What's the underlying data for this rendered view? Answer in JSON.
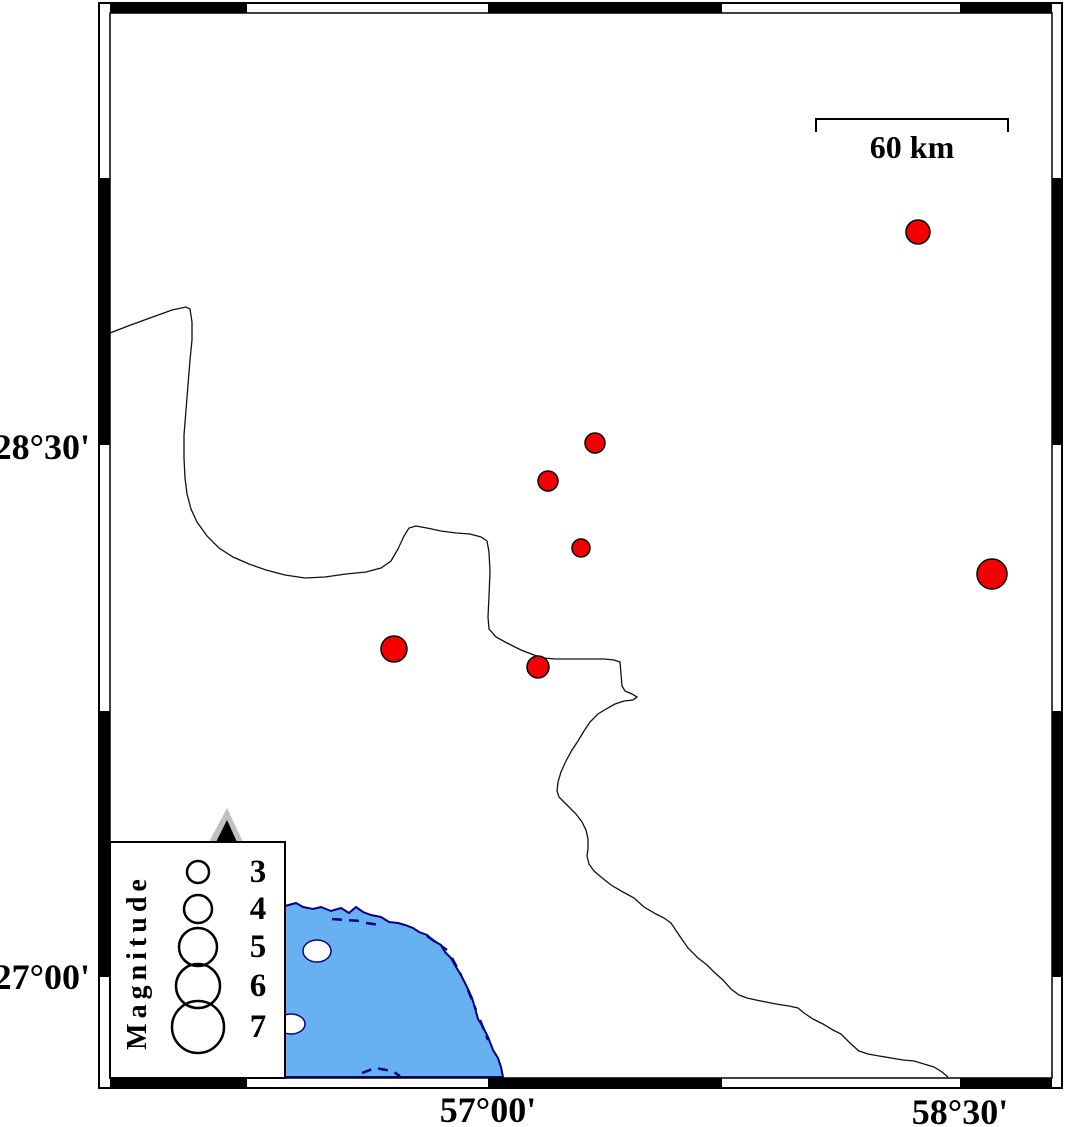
{
  "map": {
    "colors": {
      "sea_fill": "#67B1F0",
      "coast_stroke": "#00008B",
      "quake_fill": "#F50000",
      "land_fill": "#FFFFFF",
      "frame_black": "#000000",
      "volcano_gray": "#C0C0C0",
      "volcano_black": "#000000"
    },
    "frame": {
      "outer": [
        99,
        3,
        1062,
        1088
      ],
      "inner": [
        110,
        13,
        1052,
        1078
      ],
      "x_black_segments": [
        [
          110,
          247
        ],
        [
          488,
          722
        ],
        [
          960,
          1052
        ]
      ],
      "y_black_segments": [
        [
          178,
          445
        ],
        [
          711,
          977
        ]
      ]
    },
    "axis_labels": {
      "left": [
        {
          "text": "28°30'",
          "x": 90,
          "y": 447
        },
        {
          "text": "27°00'",
          "x": 90,
          "y": 977
        }
      ],
      "bottom": [
        {
          "text": "57°00'",
          "x": 488,
          "y": 1110
        },
        {
          "text": "58°30'",
          "x": 960,
          "y": 1112
        }
      ]
    },
    "scale_bar": {
      "label": "60 km",
      "x1": 816,
      "x2": 1008,
      "y": 119,
      "tick_drop": 13,
      "label_x": 912,
      "label_y": 158
    },
    "sea": {
      "waterline": [
        [
          285,
          906
        ],
        [
          296,
          903
        ],
        [
          303,
          907
        ],
        [
          313,
          909
        ],
        [
          321,
          907
        ],
        [
          331,
          911
        ],
        [
          341,
          908
        ],
        [
          349,
          913
        ],
        [
          356,
          907
        ],
        [
          363,
          912
        ],
        [
          371,
          915
        ],
        [
          381,
          917
        ],
        [
          389,
          922
        ],
        [
          398,
          923
        ],
        [
          405,
          925
        ],
        [
          413,
          928
        ],
        [
          419,
          932
        ],
        [
          427,
          935
        ],
        [
          434,
          941
        ],
        [
          441,
          945
        ],
        [
          445,
          952
        ],
        [
          451,
          958
        ],
        [
          456,
          967
        ],
        [
          461,
          975
        ],
        [
          467,
          987
        ],
        [
          472,
          998
        ],
        [
          475,
          1008
        ],
        [
          478,
          1019
        ],
        [
          483,
          1027
        ],
        [
          488,
          1037
        ],
        [
          493,
          1050
        ],
        [
          498,
          1058
        ],
        [
          501,
          1067
        ],
        [
          503,
          1077
        ]
      ],
      "close_points": [
        [
          285,
          1077
        ]
      ],
      "islands": [
        {
          "cx": 317,
          "cy": 951,
          "rx": 14,
          "ry": 11
        },
        {
          "cx": 291,
          "cy": 1024,
          "rx": 14,
          "ry": 10
        }
      ],
      "shore_dashes": [
        [
          [
            332,
            919
          ],
          [
            360,
            921
          ]
        ],
        [
          [
            366,
            923
          ],
          [
            380,
            925
          ]
        ],
        [
          [
            427,
            936
          ],
          [
            447,
            950
          ]
        ],
        [
          [
            452,
            958
          ],
          [
            461,
            975
          ]
        ],
        [
          [
            468,
            990
          ],
          [
            476,
            1010
          ]
        ],
        [
          [
            480,
            1020
          ],
          [
            488,
            1040
          ]
        ],
        [
          [
            362,
            1073
          ],
          [
            375,
            1068
          ],
          [
            392,
            1071
          ],
          [
            400,
            1076
          ]
        ]
      ]
    },
    "boundary_line": {
      "points": [
        [
          110,
          333
        ],
        [
          128,
          326
        ],
        [
          150,
          318
        ],
        [
          172,
          310
        ],
        [
          186,
          307
        ],
        [
          190,
          309
        ],
        [
          192,
          322
        ],
        [
          192,
          340
        ],
        [
          190,
          360
        ],
        [
          188,
          385
        ],
        [
          186,
          410
        ],
        [
          184,
          435
        ],
        [
          184,
          458
        ],
        [
          185,
          478
        ],
        [
          187,
          494
        ],
        [
          191,
          509
        ],
        [
          197,
          522
        ],
        [
          207,
          536
        ],
        [
          219,
          548
        ],
        [
          233,
          557
        ],
        [
          249,
          564
        ],
        [
          266,
          570
        ],
        [
          285,
          575
        ],
        [
          305,
          578
        ],
        [
          325,
          577
        ],
        [
          346,
          574
        ],
        [
          366,
          572
        ],
        [
          381,
          568
        ],
        [
          391,
          561
        ],
        [
          398,
          549
        ],
        [
          404,
          536
        ],
        [
          409,
          528
        ],
        [
          416,
          526
        ],
        [
          427,
          528
        ],
        [
          441,
          531
        ],
        [
          456,
          533
        ],
        [
          470,
          534
        ],
        [
          481,
          537
        ],
        [
          487,
          541
        ],
        [
          489,
          552
        ],
        [
          490,
          572
        ],
        [
          489,
          596
        ],
        [
          488,
          617
        ],
        [
          489,
          629
        ],
        [
          496,
          637
        ],
        [
          507,
          643
        ],
        [
          521,
          650
        ],
        [
          534,
          655
        ],
        [
          543,
          658
        ],
        [
          556,
          659
        ],
        [
          572,
          659
        ],
        [
          588,
          659
        ],
        [
          604,
          659
        ],
        [
          614,
          660
        ],
        [
          620,
          662
        ],
        [
          621,
          674
        ],
        [
          622,
          686
        ],
        [
          625,
          691
        ],
        [
          632,
          694
        ],
        [
          637,
          697
        ],
        [
          633,
          700
        ],
        [
          624,
          701
        ],
        [
          615,
          704
        ],
        [
          606,
          709
        ],
        [
          598,
          714
        ],
        [
          590,
          722
        ],
        [
          584,
          731
        ],
        [
          578,
          741
        ],
        [
          572,
          750
        ],
        [
          566,
          761
        ],
        [
          561,
          772
        ],
        [
          558,
          782
        ],
        [
          557,
          791
        ],
        [
          559,
          797
        ],
        [
          564,
          802
        ],
        [
          570,
          808
        ],
        [
          576,
          814
        ],
        [
          582,
          822
        ],
        [
          586,
          830
        ],
        [
          588,
          839
        ],
        [
          588,
          849
        ],
        [
          587,
          856
        ],
        [
          589,
          864
        ],
        [
          594,
          871
        ],
        [
          601,
          877
        ],
        [
          611,
          885
        ],
        [
          623,
          892
        ],
        [
          634,
          898
        ],
        [
          644,
          907
        ],
        [
          656,
          914
        ],
        [
          664,
          918
        ],
        [
          671,
          923
        ],
        [
          681,
          938
        ],
        [
          688,
          948
        ],
        [
          698,
          958
        ],
        [
          707,
          965
        ],
        [
          715,
          973
        ],
        [
          723,
          980
        ],
        [
          731,
          989
        ],
        [
          739,
          995
        ],
        [
          747,
          998
        ],
        [
          756,
          1000
        ],
        [
          766,
          1002
        ],
        [
          776,
          1004
        ],
        [
          789,
          1006
        ],
        [
          798,
          1008
        ],
        [
          804,
          1013
        ],
        [
          813,
          1019
        ],
        [
          823,
          1024
        ],
        [
          833,
          1030
        ],
        [
          841,
          1034
        ],
        [
          851,
          1044
        ],
        [
          859,
          1051
        ],
        [
          868,
          1054
        ],
        [
          879,
          1056
        ],
        [
          891,
          1058
        ],
        [
          903,
          1060
        ],
        [
          914,
          1061
        ],
        [
          924,
          1064
        ],
        [
          934,
          1067
        ],
        [
          942,
          1072
        ],
        [
          948,
          1077
        ]
      ]
    },
    "quakes": [
      {
        "x": 918,
        "y": 232,
        "r": 12
      },
      {
        "x": 595,
        "y": 443,
        "r": 10
      },
      {
        "x": 548,
        "y": 481,
        "r": 10
      },
      {
        "x": 581,
        "y": 548,
        "r": 9
      },
      {
        "x": 992,
        "y": 574,
        "r": 15
      },
      {
        "x": 394,
        "y": 649,
        "r": 13
      },
      {
        "x": 538,
        "y": 667,
        "r": 11
      }
    ],
    "legend": {
      "box": {
        "x": 110,
        "y": 842,
        "w": 175,
        "h": 236
      },
      "title": "Magnitude",
      "title_x": 146,
      "title_y": 962,
      "circle_cx": 198,
      "label_x": 258,
      "entries": [
        {
          "label": "3",
          "cy": 872,
          "r": 11
        },
        {
          "label": "4",
          "cy": 909,
          "r": 14
        },
        {
          "label": "5",
          "cy": 947,
          "r": 19
        },
        {
          "label": "6",
          "cy": 986,
          "r": 22
        },
        {
          "label": "7",
          "cy": 1027,
          "r": 26
        }
      ],
      "volcano": {
        "outer": [
          [
            227,
            808
          ],
          [
            209,
            842
          ],
          [
            243,
            842
          ]
        ],
        "inner": [
          [
            227,
            820
          ],
          [
            216,
            842
          ],
          [
            237,
            842
          ]
        ]
      }
    }
  }
}
